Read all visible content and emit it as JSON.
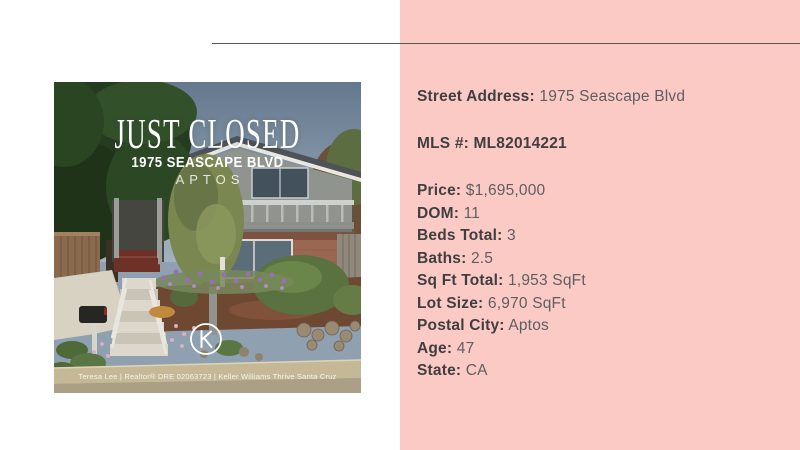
{
  "page": {
    "background": "#ffffff",
    "accent_pink": "#fccac4",
    "divider_color": "#57575a",
    "label_color": "#3f3f41",
    "value_color": "#5e5e60"
  },
  "photo_card": {
    "headline": "JUST CLOSED",
    "address_line": "1975 SEASCAPE BLVD",
    "city_line": "APTOS",
    "attribution": "Teresa Lee | Realtor® DRE 02063723 | Keller Williams Thrive Santa Cruz",
    "logo_icon": "keller-williams-k"
  },
  "details_panel": {
    "rows": [
      {
        "label": "Street Address:",
        "value": "1975 Seascape Blvd"
      },
      {
        "label": "MLS #:",
        "value": "ML82014221"
      },
      {
        "label": "Price:",
        "value": "$1,695,000"
      },
      {
        "label": "DOM:",
        "value": "11"
      },
      {
        "label": "Beds Total:",
        "value": "3"
      },
      {
        "label": "Baths:",
        "value": "2.5"
      },
      {
        "label": "Sq Ft Total:",
        "value": "1,953 SqFt"
      },
      {
        "label": "Lot Size:",
        "value": "6,970 SqFt"
      },
      {
        "label": "Postal City:",
        "value": "Aptos"
      },
      {
        "label": "Age:",
        "value": "47"
      },
      {
        "label": "State:",
        "value": "CA"
      }
    ]
  }
}
